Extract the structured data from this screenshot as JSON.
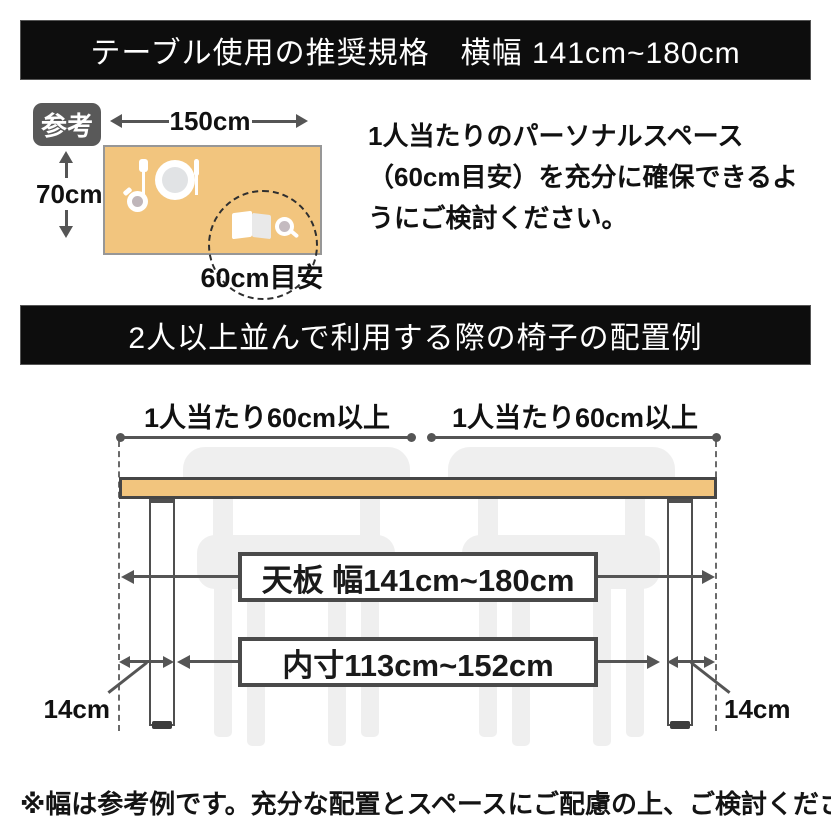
{
  "banner_top": {
    "label": "テーブル使用の推奨規格　横幅 141cm~180cm"
  },
  "reference": {
    "badge_label": "参考",
    "table_width": "150cm",
    "table_depth": "70cm",
    "space_hint": "60cm目安",
    "note": "1人当たりのパーソナルスペース（60cm目安）を充分に確保できるようにご検討ください。"
  },
  "banner_middle": {
    "label": "2人以上並んで利用する際の椅子の配置例"
  },
  "diagram": {
    "per_person_left": "1人当たり60cm以上",
    "per_person_right": "1人当たり60cm以上",
    "tabletop_width": "天板 幅141cm~180cm",
    "inner_width": "内寸113cm~152cm",
    "leg_inset_left": "14cm",
    "leg_inset_right": "14cm"
  },
  "footnote": "※幅は参考例です。充分な配置とスペースにご配慮の上、ご検討ください。",
  "colors": {
    "banner_bg": "#0D0D0D",
    "banner_text": "#FFFFFF",
    "table_fill": "#F2C57E",
    "outline": "#4A4A4A",
    "chair_fill": "#EFEFEF",
    "badge_bg": "#595959",
    "arrow": "#555555",
    "text": "#1A1A1A"
  }
}
